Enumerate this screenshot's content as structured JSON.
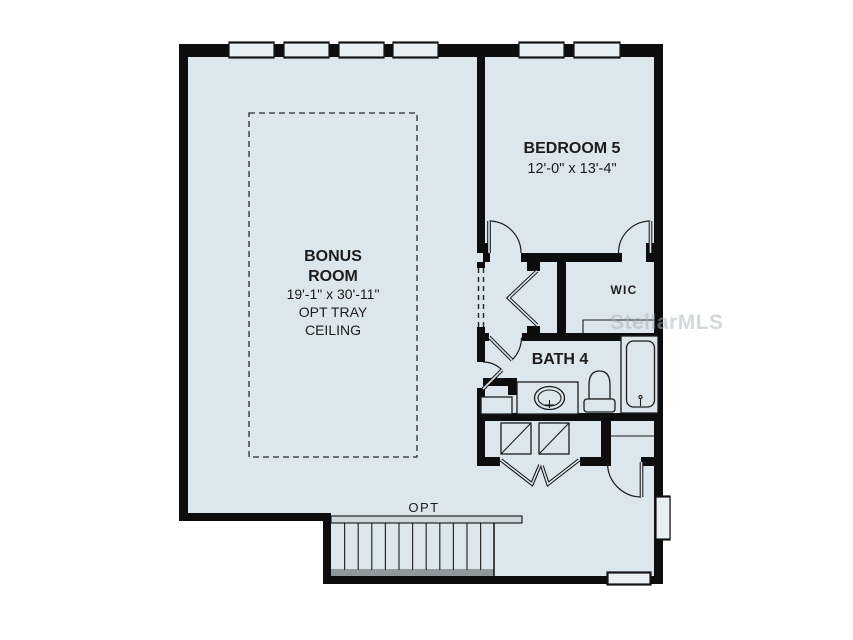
{
  "meta": {
    "watermark": "StellarMLS"
  },
  "colors": {
    "floor": "#dbe7ed",
    "wall": "#0d0d0d",
    "line": "#1c1c1c",
    "window_fill": "#e9f0f4",
    "stair_strip": "#8f989c",
    "railing": "#ccd7dc",
    "text": "#1c1c1c",
    "watermark": "#a9b3b9"
  },
  "rooms": {
    "bonus": {
      "name_line1": "BONUS",
      "name_line2": "ROOM",
      "dimensions": "19'-1\" x 30'-11\"",
      "note_line1": "OPT TRAY",
      "note_line2": "CEILING"
    },
    "bedroom5": {
      "name": "BEDROOM 5",
      "dimensions": "12'-0\" x 13'-4\""
    },
    "wic": {
      "name": "WIC"
    },
    "bath4": {
      "name": "BATH 4"
    }
  },
  "stairs": {
    "label": "OPT"
  }
}
